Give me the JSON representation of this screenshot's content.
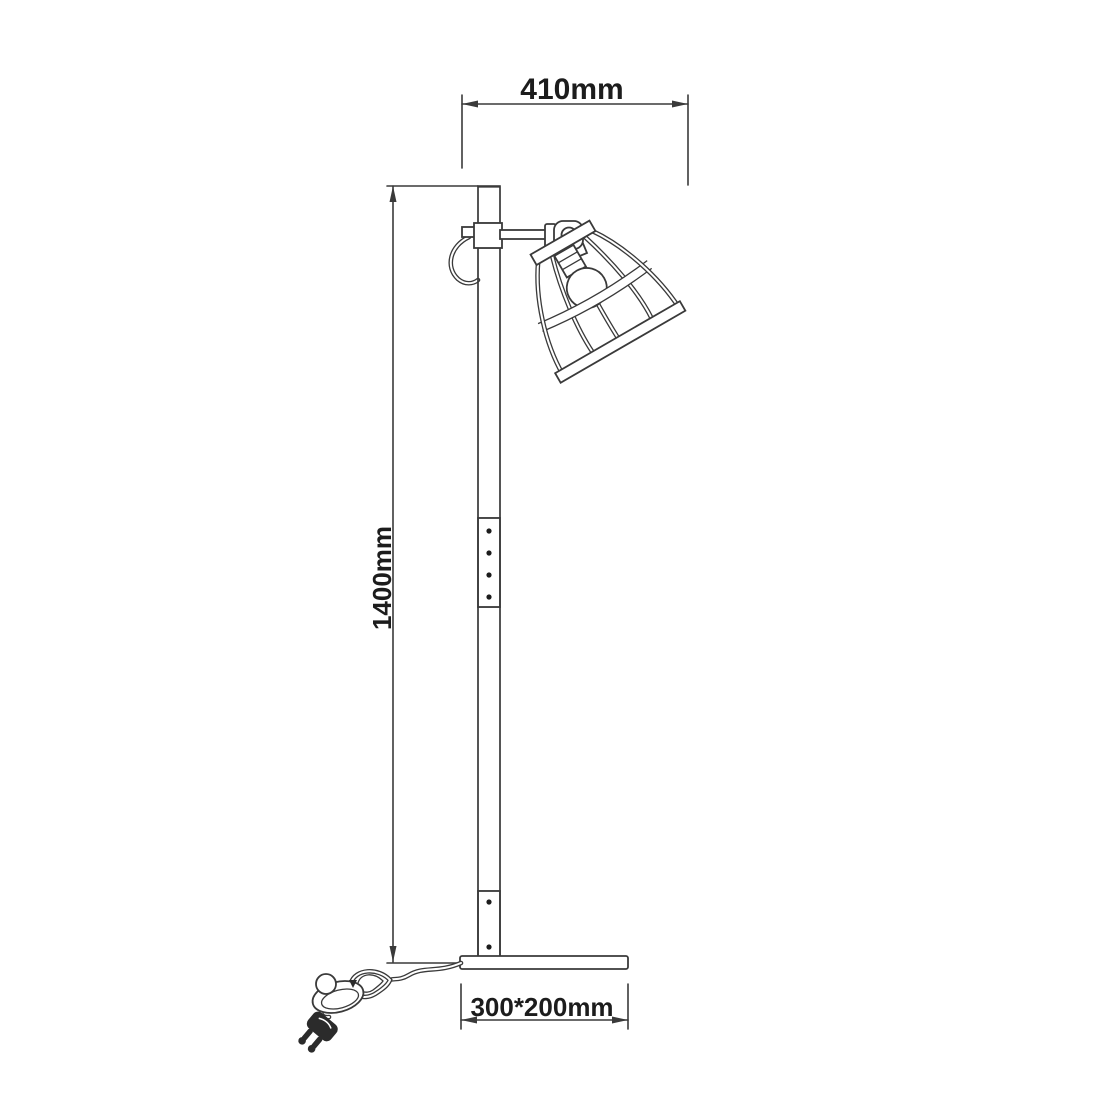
{
  "diagram": {
    "dimensions": {
      "head_width": "410mm",
      "height": "1400mm",
      "base_size": "300*200mm"
    },
    "parts": [
      "cage-shade",
      "bulb",
      "pivot-joint",
      "arm",
      "pole",
      "base-plate",
      "power-cord",
      "foot-switch",
      "power-plug"
    ]
  },
  "colors": {
    "line": "#3a3a3a",
    "background": "#ffffff",
    "mesh_fill": "#4f4f4f",
    "text": "#1c1c1c"
  }
}
